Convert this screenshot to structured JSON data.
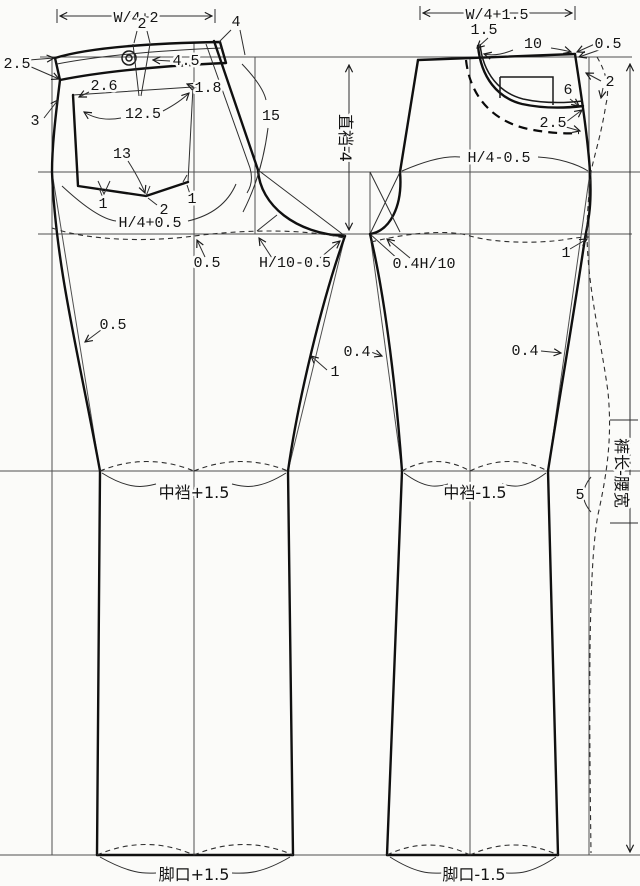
{
  "style": {
    "ink": "#141414",
    "background": "#fbfbf9"
  },
  "front": {
    "waist_width": "W/4+2",
    "dart_width": "2",
    "fly_corner": "4",
    "band_width": "2.5",
    "band_extension": "4.5",
    "fly_width": "1.8",
    "pocket_opening": "2.6",
    "side_notch": "3",
    "pocket_slant": "12.5",
    "pocket_depth": "13",
    "rise_length": "15",
    "pocket_dart_left": "1",
    "pocket_dart_center": "2",
    "pocket_dart_right": "1",
    "hip_width": "H/4+0.5",
    "crease_offset": "0.5",
    "crotch_extension": "H/10-0.5",
    "side_seam_offset": "0.5",
    "inseam_offset": "1",
    "knee_width": "中裆+1.5",
    "hem_width": "脚口+1.5"
  },
  "back": {
    "waist_width": "W/4+1.5",
    "yoke_rise": "1.5",
    "yoke_width": "10",
    "waist_raise": "0.5",
    "side_curve_offset": "2",
    "pocket_height": "6",
    "pocket_offset": "2.5",
    "hip_width": "H/4-0.5",
    "crotch_extension": "0.4H/10",
    "hip_side_offset": "1",
    "inseam_offset": "0.4",
    "side_seam_offset": "0.4",
    "knee_width": "中裆-1.5",
    "knee_diff": "5",
    "hem_width": "脚口-1.5"
  },
  "dims": {
    "rise_depth": "直裆-4",
    "length": "裤长-腰宽"
  }
}
